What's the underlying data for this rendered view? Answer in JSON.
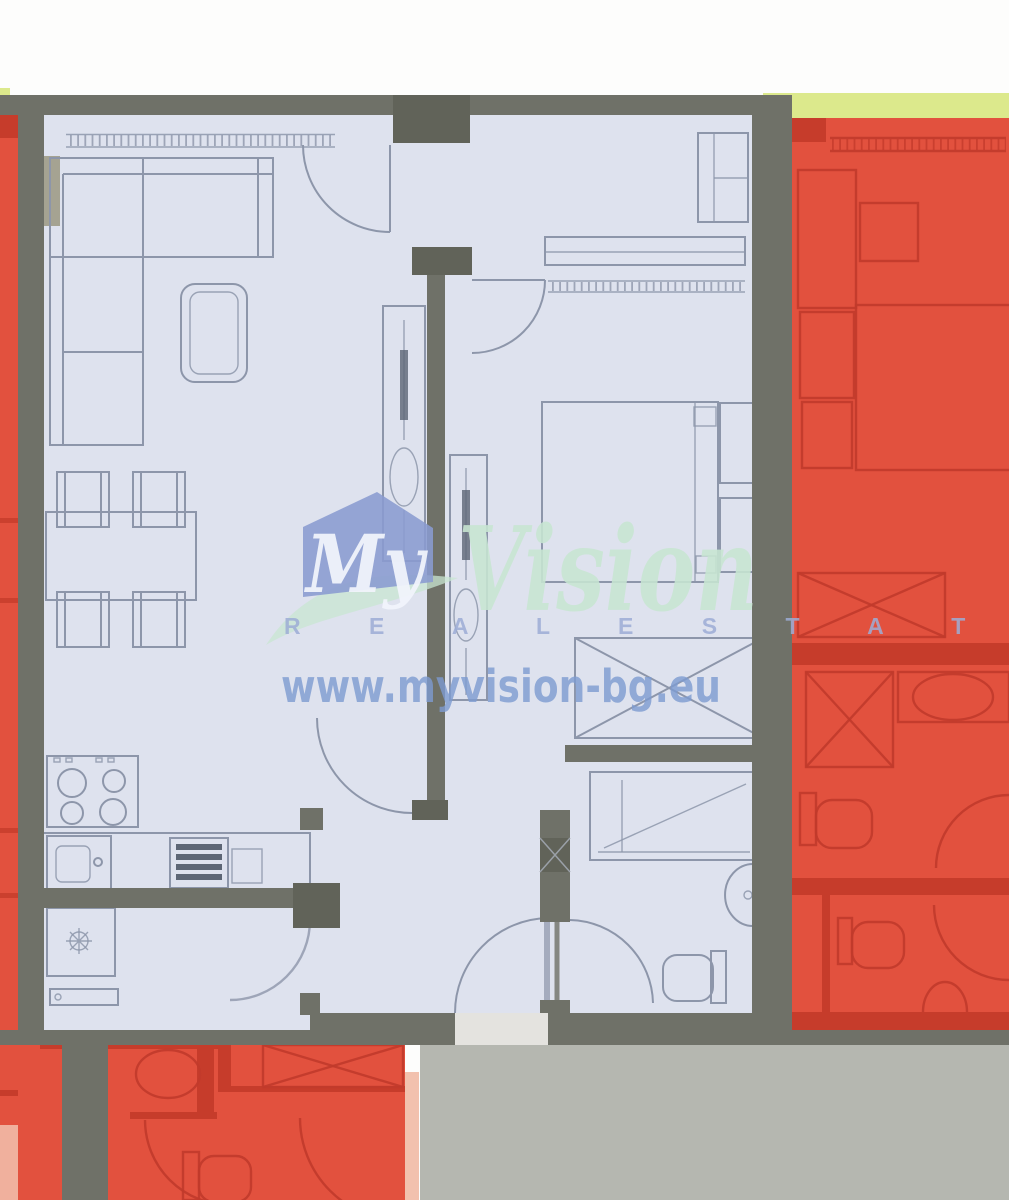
{
  "watermark": {
    "brand_word_1": "My",
    "brand_word_2": "Vision",
    "tagline": "R E A L   E S T A T E",
    "website": "www.myvision-bg.eu"
  },
  "colors": {
    "background": "#fdfdfc",
    "wall": "#6f7168",
    "wall_dark": "#616359",
    "featured_unit_fill": "#dee2ee",
    "furniture_line": "#8d96aa",
    "appliance_dark": "#5d6675",
    "accent_tan": "#a5a392",
    "adjacent_unit_fill": "#e2513e",
    "adjacent_unit_line": "#c13a2b",
    "adjacent_unit_wall": "#c63c2b",
    "balcony_strip": "#dce98c",
    "ground": "#b5b7b0",
    "pink_strip": "#f2c1ae",
    "entry_gap": "#e4e3df",
    "watermark_house": "#8a9bd0",
    "watermark_green": "#c8e6d2",
    "watermark_white": "#f2f5fc",
    "watermark_tagline": "#9dadd6",
    "watermark_url": "#7d9bd1"
  }
}
